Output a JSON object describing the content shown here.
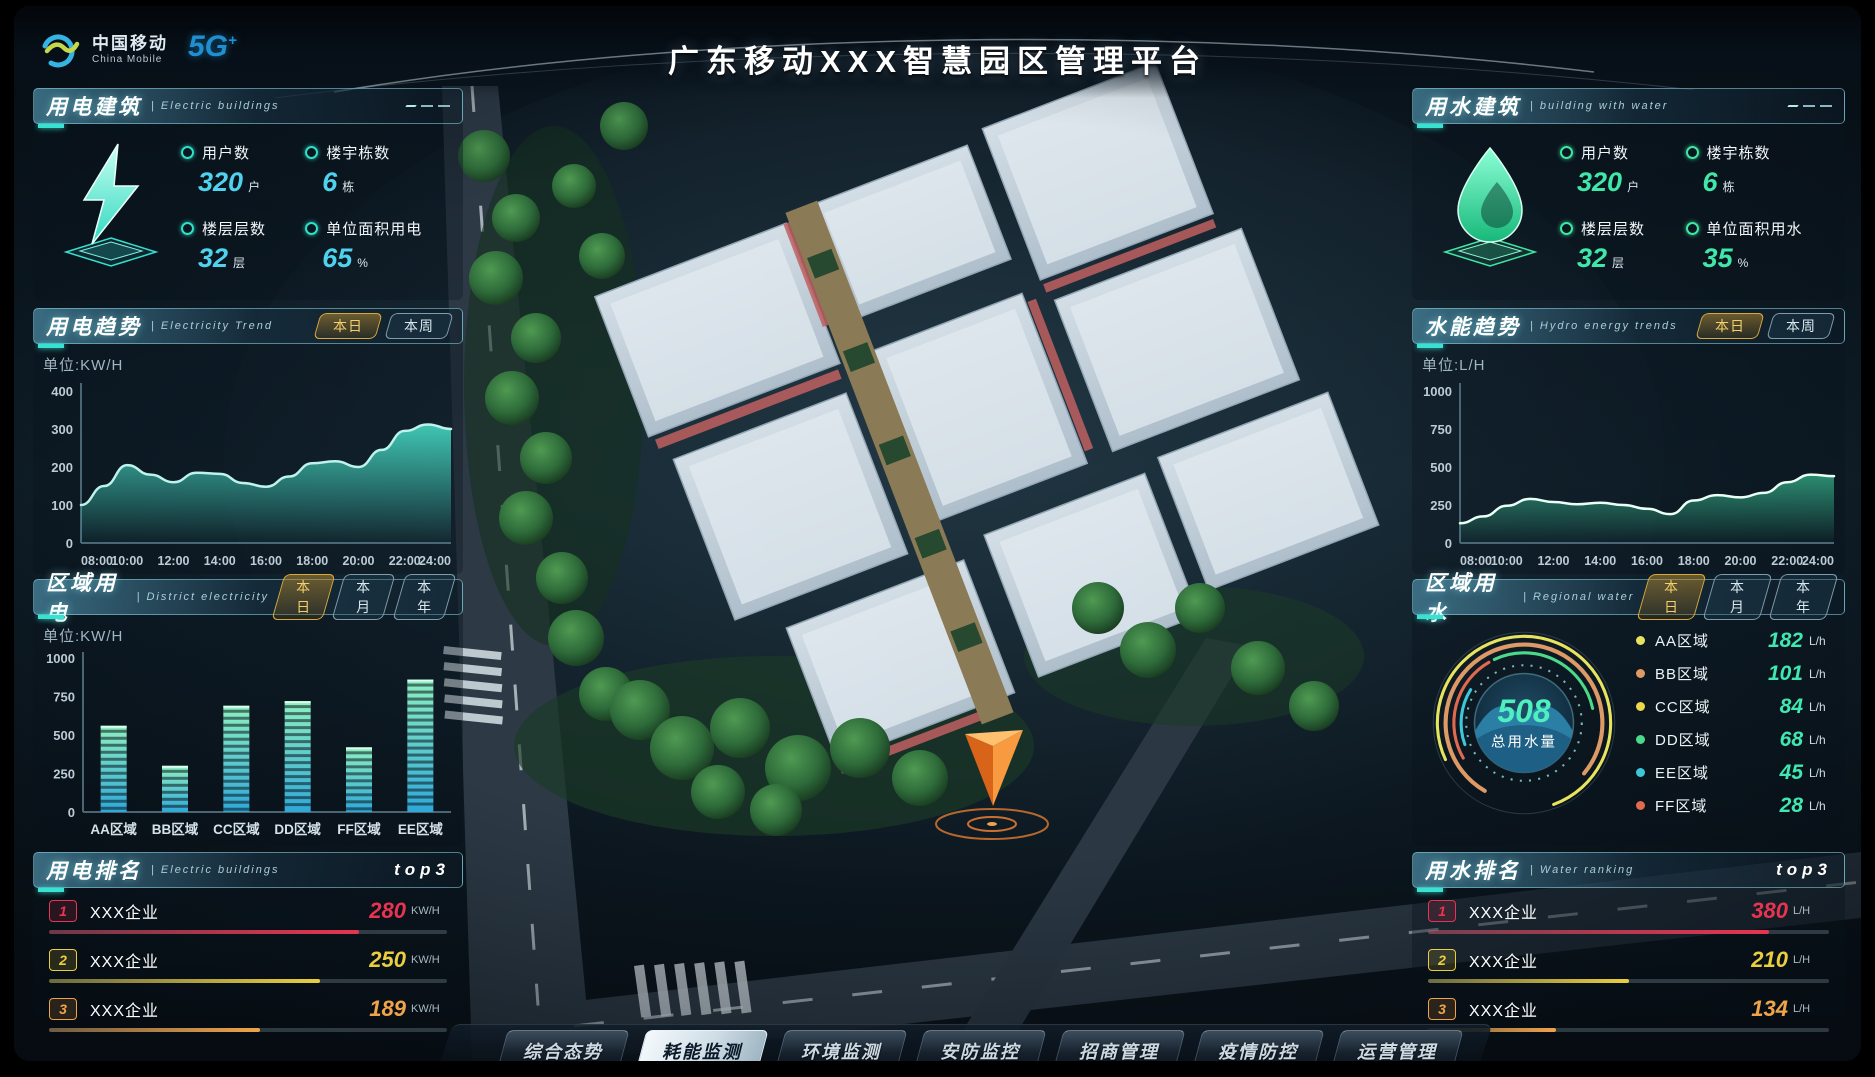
{
  "header": {
    "brand_cn": "中国移动",
    "brand_en": "China Mobile",
    "badge": "5G",
    "badge_plus": "+",
    "title": "广东移动XXX智慧园区管理平台"
  },
  "panels": {
    "electric_building": {
      "title": "用电建筑",
      "subtitle": "| Electric buildings",
      "stats": [
        {
          "label": "用户数",
          "value": "320",
          "unit": "户"
        },
        {
          "label": "楼宇栋数",
          "value": "6",
          "unit": "栋"
        },
        {
          "label": "楼层层数",
          "value": "32",
          "unit": "层"
        },
        {
          "label": "单位面积用电",
          "value": "65",
          "unit": "%"
        }
      ]
    },
    "electricity_trend": {
      "title": "用电趋势",
      "subtitle": "| Electricity Trend",
      "unit": "单位:KW/H",
      "tabs": [
        {
          "label": "本日",
          "active": true
        },
        {
          "label": "本周",
          "active": false
        }
      ]
    },
    "district_electricity": {
      "title": "区域用电",
      "subtitle": "| District electricity",
      "unit": "单位:KW/H",
      "tabs": [
        {
          "label": "本日",
          "active": true
        },
        {
          "label": "本月",
          "active": false
        },
        {
          "label": "本年",
          "active": false
        }
      ]
    },
    "electric_ranking": {
      "title": "用电排名",
      "subtitle": "| Electric buildings",
      "badge": "top3",
      "rows": [
        {
          "rank": "1",
          "name": "XXX企业",
          "value": "280",
          "unit": "KW/H",
          "color": "#e83450",
          "pct": 78
        },
        {
          "rank": "2",
          "name": "XXX企业",
          "value": "250",
          "unit": "KW/H",
          "color": "#eace3f",
          "pct": 68
        },
        {
          "rank": "3",
          "name": "XXX企业",
          "value": "189",
          "unit": "KW/H",
          "color": "#f0a348",
          "pct": 53
        }
      ]
    },
    "water_building": {
      "title": "用水建筑",
      "subtitle": "| building with water",
      "stats": [
        {
          "label": "用户数",
          "value": "320",
          "unit": "户"
        },
        {
          "label": "楼宇栋数",
          "value": "6",
          "unit": "栋"
        },
        {
          "label": "楼层层数",
          "value": "32",
          "unit": "层"
        },
        {
          "label": "单位面积用水",
          "value": "35",
          "unit": "%"
        }
      ]
    },
    "hydro_trend": {
      "title": "水能趋势",
      "subtitle": "| Hydro energy trends",
      "unit": "单位:L/H",
      "tabs": [
        {
          "label": "本日",
          "active": true
        },
        {
          "label": "本周",
          "active": false
        }
      ]
    },
    "regional_water": {
      "title": "区域用水",
      "subtitle": "| Regional water",
      "tabs": [
        {
          "label": "本日",
          "active": true
        },
        {
          "label": "本月",
          "active": false
        },
        {
          "label": "本年",
          "active": false
        }
      ]
    },
    "water_ranking": {
      "title": "用水排名",
      "subtitle": "| Water ranking",
      "badge": "top3",
      "rows": [
        {
          "rank": "1",
          "name": "XXX企业",
          "value": "380",
          "unit": "L/H",
          "color": "#e83450",
          "pct": 85
        },
        {
          "rank": "2",
          "name": "XXX企业",
          "value": "210",
          "unit": "L/H",
          "color": "#eace3f",
          "pct": 50
        },
        {
          "rank": "3",
          "name": "XXX企业",
          "value": "134",
          "unit": "L/H",
          "color": "#f0a348",
          "pct": 32
        }
      ]
    }
  },
  "chart_data": [
    {
      "id": "electricity-trend",
      "type": "area",
      "title": "用电趋势",
      "ylabel": "KW/H",
      "x_labels": [
        "08:00",
        "10:00",
        "12:00",
        "14:00",
        "16:00",
        "18:00",
        "20:00",
        "22:00",
        "24:00"
      ],
      "values": [
        100,
        150,
        205,
        180,
        160,
        185,
        182,
        158,
        148,
        175,
        210,
        215,
        200,
        245,
        295,
        312,
        300
      ],
      "ylim": [
        0,
        400
      ],
      "yticks": [
        0,
        100,
        200,
        300,
        400
      ],
      "line_color": "#bef2ec",
      "fill_color": "#45d8c2"
    },
    {
      "id": "district-electricity",
      "type": "bar",
      "title": "区域用电",
      "ylabel": "KW/H",
      "categories": [
        "AA区域",
        "BB区域",
        "CC区域",
        "DD区域",
        "FF区域",
        "EE区域"
      ],
      "values": [
        560,
        300,
        690,
        720,
        420,
        860
      ],
      "ylim": [
        0,
        1000
      ],
      "yticks": [
        0,
        250,
        500,
        750,
        1000
      ],
      "bar_top": "#8ef0c0",
      "bar_bottom": "#2fa8d8"
    },
    {
      "id": "hydro-trend",
      "type": "area",
      "title": "水能趋势",
      "ylabel": "L/H",
      "x_labels": [
        "08:00",
        "10:00",
        "12:00",
        "14:00",
        "16:00",
        "18:00",
        "20:00",
        "22:00",
        "24:00"
      ],
      "values": [
        130,
        175,
        245,
        290,
        270,
        255,
        265,
        250,
        225,
        190,
        280,
        315,
        300,
        330,
        400,
        450,
        440
      ],
      "ylim": [
        0,
        1000
      ],
      "yticks": [
        0,
        250,
        500,
        750,
        1000
      ],
      "line_color": "#eafff6",
      "fill_color": "#2f9a7a"
    },
    {
      "id": "regional-water",
      "type": "donut",
      "title": "区域用水",
      "total": "508",
      "label": "总用水量",
      "legend": [
        {
          "name": "AA区域",
          "value": "182",
          "unit": "L/h",
          "color": "#e7e35e"
        },
        {
          "name": "BB区域",
          "value": "101",
          "unit": "L/h",
          "color": "#dd9a66"
        },
        {
          "name": "CC区域",
          "value": "84",
          "unit": "L/h",
          "color": "#ecd84a"
        },
        {
          "name": "DD区域",
          "value": "68",
          "unit": "L/h",
          "color": "#4cd98a"
        },
        {
          "name": "EE区域",
          "value": "45",
          "unit": "L/h",
          "color": "#3cc8d8"
        },
        {
          "name": "FF区域",
          "value": "28",
          "unit": "L/h",
          "color": "#e06a50"
        }
      ]
    }
  ],
  "nav": {
    "items": [
      {
        "label": "综合态势",
        "active": false
      },
      {
        "label": "耗能监测",
        "active": true
      },
      {
        "label": "环境监测",
        "active": false
      },
      {
        "label": "安防监控",
        "active": false
      },
      {
        "label": "招商管理",
        "active": false
      },
      {
        "label": "疫情防控",
        "active": false
      },
      {
        "label": "运营管理",
        "active": false
      }
    ]
  }
}
